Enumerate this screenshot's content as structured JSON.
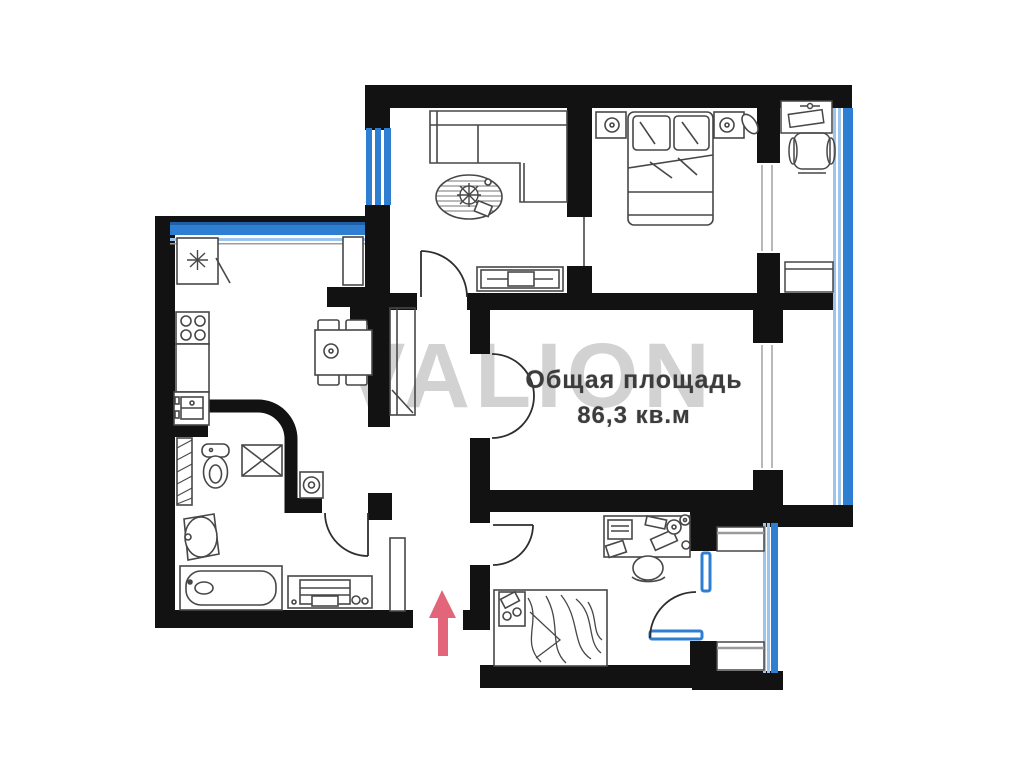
{
  "floor_plan": {
    "watermark": "VALION",
    "area_title": "Общая площадь",
    "area_value": "86,3 кв.м",
    "entrance_arrow_direction": "up",
    "rooms": [
      "kitchen",
      "bathroom",
      "hallway",
      "living-room",
      "bedroom",
      "big-room",
      "small-bedroom",
      "balcony",
      "small-balcony"
    ],
    "furniture_symbols": [
      "fridge-icon",
      "tall-cabinet-icon",
      "stove-icon",
      "kitchen-sink-icon",
      "dining-table-icon",
      "chair-icon",
      "toilet-icon",
      "washing-machine-icon",
      "water-heater-icon",
      "wash-basin-icon",
      "bathtub-icon",
      "dresser-icon",
      "wardrobe-icon",
      "mirror-icon",
      "corner-sofa-icon",
      "rug-plant-icon",
      "tv-stand-icon",
      "double-bed-icon",
      "nightstand-icon",
      "single-bed-icon",
      "desk-computer-icon",
      "desk-chair-icon",
      "balcony-desk-icon",
      "balcony-chair-icon",
      "balcony-cabinet-icon"
    ],
    "colors": {
      "wall": "#121212",
      "window_blue": "#2e7ed2",
      "window_blue_light": "#9dc4ec",
      "window_navy": "#1e5fa8",
      "furniture_line": "#474747",
      "arrow_red": "#e0586e",
      "watermark_gray": "#d2d2d2",
      "text_gray": "#3c3c3c"
    }
  }
}
